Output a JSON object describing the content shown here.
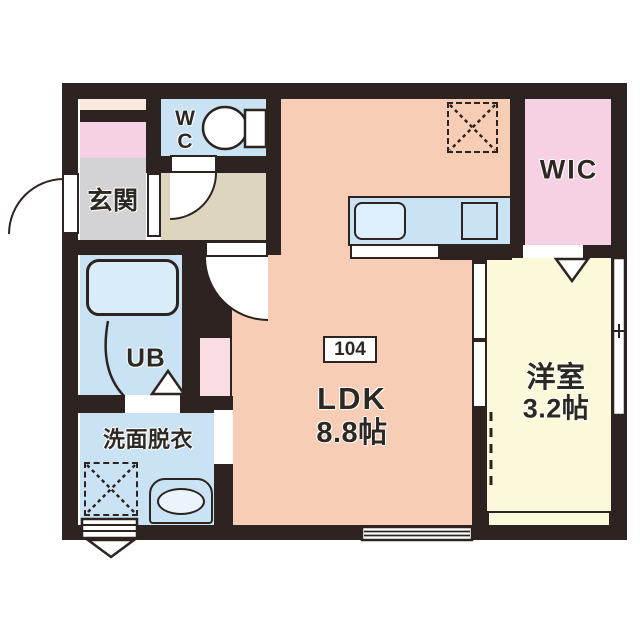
{
  "plan": {
    "title": "1R apartment floor plan",
    "unit_number": "104",
    "rooms": {
      "genkan": {
        "label": "玄関"
      },
      "wc": {
        "label": "WC"
      },
      "ub": {
        "label": "UB"
      },
      "senmen": {
        "label": "洗面脱衣"
      },
      "ldk": {
        "label": "LDK",
        "size": "8.8帖"
      },
      "yoshitsu": {
        "label": "洋室",
        "size": "3.2帖"
      },
      "wic": {
        "label": "WIC"
      }
    },
    "fixtures": [
      "toilet",
      "bathtub",
      "kitchen-counter",
      "kitchen-sink",
      "stove",
      "refrigerator-space",
      "washing-machine-space",
      "washbasin",
      "entry-door",
      "hinged-doors",
      "sliding-door",
      "windows",
      "louver-vent"
    ],
    "colors": {
      "wall": "#2d2320",
      "ldk": "#f7cdb6",
      "wet_rooms": "#c9e3f4",
      "bathtub": "#d9edf8",
      "hallway": "#ddd6bf",
      "genkan": "#d3d3d5",
      "closet_pink": "#f6d0e3",
      "peach": "#fae9de",
      "pipe_space": "#fadde3",
      "bedroom_yellow": "#fcf8da",
      "text": "#2e2823"
    }
  }
}
